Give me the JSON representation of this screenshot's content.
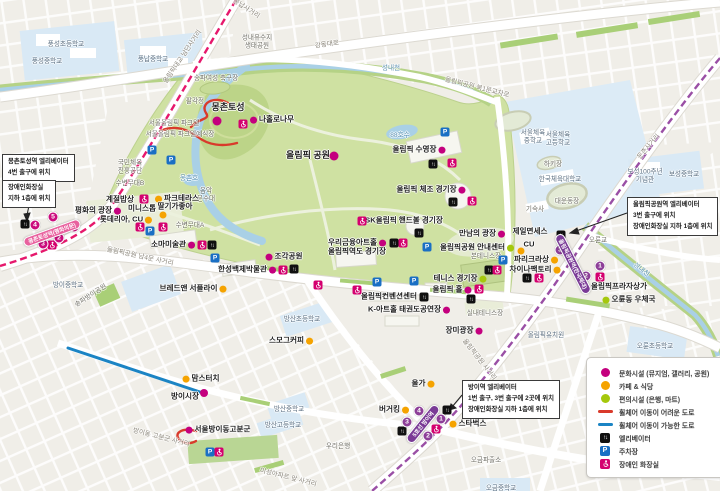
{
  "map": {
    "legend": {
      "items": [
        {
          "icon": "dot",
          "color": "#c4007e",
          "label": "문화시설 (뮤지엄, 갤러리, 공원)"
        },
        {
          "icon": "dot",
          "color": "#f5a300",
          "label": "카페 & 식당"
        },
        {
          "icon": "dot",
          "color": "#a5c80c",
          "label": "편의시설 (은행, 마트)"
        },
        {
          "icon": "line",
          "color": "#d93a2b",
          "label": "휠체어 이동이 어려운 도로"
        },
        {
          "icon": "line",
          "color": "#1b84c4",
          "label": "휠체어 이동이 가능한 도로"
        },
        {
          "icon": "elevator",
          "color": "#101010",
          "label": "엘리베이터"
        },
        {
          "icon": "parking",
          "color": "#1a6fc4",
          "label": "주차장"
        },
        {
          "icon": "toilet",
          "color": "#d4006f",
          "label": "장애인 화장실"
        }
      ]
    },
    "infoboxes": [
      {
        "id": "box-mongchon-elevator",
        "x": 2,
        "y": 154,
        "lines": [
          "몽촌토성역 엘리베이터",
          "4번 출구에 위치"
        ]
      },
      {
        "id": "box-mongchon-toilet",
        "x": 2,
        "y": 180,
        "lines": [
          "장애인화장실",
          "지하 1층에 위치"
        ]
      },
      {
        "id": "box-olympicpark-station",
        "x": 627,
        "y": 197,
        "lines": [
          "올림픽공원역 엘리베이터",
          "3번 출구에 위치",
          "장애인화장실 지하 1층에 위치"
        ]
      },
      {
        "id": "box-bangi-station",
        "x": 462,
        "y": 380,
        "lines": [
          "방이역 엘리베이터",
          "1번 출구, 3번 출구에 2곳에 위치",
          "장애인화장실 지하 1층에 위치"
        ]
      }
    ],
    "stations": [
      {
        "name": "몽촌토성역(평화의문)",
        "x": 52,
        "y": 233,
        "w": 60,
        "rot": -20,
        "color": "#e8619e"
      },
      {
        "name": "올림픽공원역(한국체대)",
        "x": 573,
        "y": 264,
        "w": 66,
        "rot": 63,
        "color": "#7a3b96"
      },
      {
        "name": "5호선 방이역",
        "x": 423,
        "y": 424,
        "w": 46,
        "rot": -51,
        "color": "#7a3b96"
      }
    ],
    "exits": [
      {
        "n": "1",
        "x": 74,
        "y": 227,
        "color": "#cb0c7d"
      },
      {
        "n": "2",
        "x": 59,
        "y": 238,
        "color": "#cb0c7d"
      },
      {
        "n": "3",
        "x": 43,
        "y": 244,
        "color": "#cb0c7d"
      },
      {
        "n": "4",
        "x": 35,
        "y": 225,
        "color": "#cb0c7d"
      },
      {
        "n": "5",
        "x": 53,
        "y": 217,
        "color": "#cb0c7d"
      },
      {
        "n": "3",
        "x": 560,
        "y": 250,
        "color": "#8d3f98"
      },
      {
        "n": "1",
        "x": 600,
        "y": 266,
        "color": "#8d3f98"
      },
      {
        "n": "2",
        "x": 586,
        "y": 276,
        "color": "#8d3f98"
      },
      {
        "n": "4",
        "x": 419,
        "y": 411,
        "color": "#8d3f98"
      },
      {
        "n": "3",
        "x": 407,
        "y": 422,
        "color": "#8d3f98"
      },
      {
        "n": "1",
        "x": 441,
        "y": 419,
        "color": "#8d3f98"
      },
      {
        "n": "2",
        "x": 428,
        "y": 436,
        "color": "#8d3f98"
      }
    ],
    "pois": [
      {
        "label": "풍성초등학교",
        "x": 66,
        "y": 45,
        "cls": "school"
      },
      {
        "label": "풍성중학교",
        "x": 47,
        "y": 62,
        "cls": "school"
      },
      {
        "label": "풍납중학교",
        "x": 153,
        "y": 60,
        "cls": "school"
      },
      {
        "lines": [
          "성내유수지",
          "생태공원"
        ],
        "x": 257,
        "y": 42,
        "cls": "area"
      },
      {
        "label": "송파여성 축구장",
        "x": 216,
        "y": 79,
        "cls": "area"
      },
      {
        "label": "팔각정",
        "x": 195,
        "y": 102,
        "cls": "area"
      },
      {
        "label": "서울올림픽 파크텔",
        "x": 174,
        "y": 124,
        "cls": "area"
      },
      {
        "label": "서울올림픽 파크텔예식장",
        "x": 180,
        "y": 135,
        "cls": "area"
      },
      {
        "label": "몽촌토성",
        "x": 228,
        "y": 107,
        "cls": "big"
      },
      {
        "label": "나홀로나무",
        "x": 272,
        "y": 120,
        "cls": "bold",
        "dot": {
          "color": "#c4007e",
          "side": "left"
        }
      },
      {
        "label": "올림픽 공원",
        "x": 308,
        "y": 155,
        "cls": "big"
      },
      {
        "label": "88호수",
        "x": 400,
        "y": 136,
        "cls": "water"
      },
      {
        "label": "몽촌호",
        "x": 189,
        "y": 179,
        "cls": "water"
      },
      {
        "lines": [
          "음악",
          "분수대"
        ],
        "x": 206,
        "y": 195,
        "cls": "area"
      },
      {
        "label": "수변무대B",
        "x": 130,
        "y": 184,
        "cls": "area"
      },
      {
        "label": "수변무대A",
        "x": 190,
        "y": 226,
        "cls": "area"
      },
      {
        "lines": [
          "국민체육",
          "진흥공단"
        ],
        "x": 130,
        "y": 167,
        "cls": "area"
      },
      {
        "label": "계절밥상",
        "x": 120,
        "y": 200,
        "cls": "bold"
      },
      {
        "label": "파크테라스",
        "x": 177,
        "y": 199,
        "cls": "bold",
        "dot": {
          "color": "#f5a300",
          "side": "left"
        }
      },
      {
        "label": "평화의 광장",
        "x": 98,
        "y": 211,
        "cls": "bold",
        "dot": {
          "color": "#c4007e",
          "side": "right"
        }
      },
      {
        "label": "미니스톱",
        "x": 142,
        "y": 209,
        "cls": "bold"
      },
      {
        "label": "딸기가좋아",
        "x": 175,
        "y": 207,
        "cls": "bold"
      },
      {
        "label": "롯데리아, CU",
        "x": 126,
        "y": 220,
        "cls": "bold",
        "dot": {
          "color": "#f5a300",
          "side": "right"
        }
      },
      {
        "label": "소마미술관",
        "x": 173,
        "y": 245,
        "cls": "bold",
        "dot": {
          "color": "#c4007e",
          "side": "right"
        }
      },
      {
        "label": "조각공원",
        "x": 284,
        "y": 257,
        "cls": "bold",
        "dot": {
          "color": "#c4007e",
          "side": "left"
        }
      },
      {
        "label": "한성백제박물관",
        "x": 247,
        "y": 270,
        "cls": "bold",
        "dot": {
          "color": "#c4007e",
          "side": "right"
        }
      },
      {
        "label": "브레드앤 서플라이",
        "x": 193,
        "y": 289,
        "cls": "bold",
        "dot": {
          "color": "#f5a300",
          "side": "right"
        }
      },
      {
        "label": "우리금융아트홀",
        "x": 357,
        "y": 243,
        "cls": "bold",
        "dot": {
          "color": "#c4007e",
          "side": "right"
        }
      },
      {
        "label": "올림픽역도 경기장",
        "x": 357,
        "y": 252,
        "cls": "bold"
      },
      {
        "label": "SK올림픽 핸드볼 경기장",
        "x": 404,
        "y": 221,
        "cls": "bold"
      },
      {
        "label": "올림픽 수영장",
        "x": 419,
        "y": 150,
        "cls": "bold",
        "dot": {
          "color": "#c4007e",
          "side": "right"
        }
      },
      {
        "label": "올림픽 체조 경기장",
        "x": 431,
        "y": 190,
        "cls": "bold",
        "dot": {
          "color": "#c4007e",
          "side": "right"
        }
      },
      {
        "label": "만남의 광장",
        "x": 482,
        "y": 234,
        "cls": "bold",
        "dot": {
          "color": "#c4007e",
          "side": "right"
        }
      },
      {
        "label": "올림픽공원 안내센터",
        "x": 477,
        "y": 248,
        "cls": "bold",
        "dot": {
          "color": "#a5c80c",
          "side": "right"
        }
      },
      {
        "label": "본테니스장",
        "x": 486,
        "y": 257,
        "cls": "area"
      },
      {
        "label": "테니스 경기장",
        "x": 460,
        "y": 279,
        "cls": "bold",
        "dot": {
          "color": "#a5c80c",
          "side": "right"
        }
      },
      {
        "label": "올림픽 홀",
        "x": 452,
        "y": 290,
        "cls": "bold",
        "dot": {
          "color": "#c4007e",
          "side": "right"
        }
      },
      {
        "label": "올림픽컨벤션센터",
        "x": 389,
        "y": 297,
        "cls": "bold"
      },
      {
        "label": "K-아트홀 태권도공연장",
        "x": 409,
        "y": 310,
        "cls": "bold",
        "dot": {
          "color": "#c4007e",
          "side": "right"
        }
      },
      {
        "label": "장미광장",
        "x": 464,
        "y": 331,
        "cls": "bold",
        "dot": {
          "color": "#c4007e",
          "side": "right"
        }
      },
      {
        "label": "실내테니스장",
        "x": 485,
        "y": 314,
        "cls": "area"
      },
      {
        "label": "제일면세스",
        "x": 530,
        "y": 232,
        "cls": "bold"
      },
      {
        "label": "CU",
        "x": 529,
        "y": 245,
        "cls": "bold"
      },
      {
        "label": "파리크라상",
        "x": 536,
        "y": 260,
        "cls": "bold",
        "dot": {
          "color": "#f5a300",
          "side": "right"
        }
      },
      {
        "label": "차이나팩토리",
        "x": 535,
        "y": 270,
        "cls": "bold",
        "dot": {
          "color": "#f5a300",
          "side": "right"
        }
      },
      {
        "lines": [
          "서울체육",
          "중학교"
        ],
        "x": 533,
        "y": 137,
        "cls": "school"
      },
      {
        "lines": [
          "서울체육",
          "고등학교"
        ],
        "x": 558,
        "y": 139,
        "cls": "school"
      },
      {
        "label": "하키장",
        "x": 553,
        "y": 165,
        "cls": "area"
      },
      {
        "label": "한국체육대학교",
        "x": 560,
        "y": 180,
        "cls": "school"
      },
      {
        "label": "대운동장",
        "x": 567,
        "y": 202,
        "cls": "area"
      },
      {
        "label": "기숙사",
        "x": 535,
        "y": 210,
        "cls": "area"
      },
      {
        "lines": [
          "보성100주년",
          "기념관"
        ],
        "x": 645,
        "y": 176,
        "cls": "school"
      },
      {
        "label": "보성중학교",
        "x": 684,
        "y": 175,
        "cls": "school"
      },
      {
        "label": "올림픽프라자상가",
        "x": 619,
        "y": 287,
        "cls": "bold"
      },
      {
        "label": "오륜동 우체국",
        "x": 629,
        "y": 300,
        "cls": "bold",
        "dot": {
          "color": "#a5c80c",
          "side": "left"
        }
      },
      {
        "label": "오륜교",
        "x": 598,
        "y": 241,
        "cls": "area"
      },
      {
        "label": "성내천",
        "x": 391,
        "y": 69,
        "cls": "water"
      },
      {
        "label": "성내천",
        "x": 641,
        "y": 270,
        "cls": "water",
        "rot": 38
      },
      {
        "label": "오륜초등학교",
        "x": 655,
        "y": 347,
        "cls": "school"
      },
      {
        "label": "올림픽유치원",
        "x": 546,
        "y": 336,
        "cls": "school"
      },
      {
        "label": "오금파출소",
        "x": 486,
        "y": 461,
        "cls": "area"
      },
      {
        "label": "오금중학교",
        "x": 501,
        "y": 489,
        "cls": "school"
      },
      {
        "label": "우리은행",
        "x": 338,
        "y": 447,
        "cls": "area"
      },
      {
        "label": "올가",
        "x": 423,
        "y": 384,
        "cls": "bold",
        "dot": {
          "color": "#f5a300",
          "side": "right"
        }
      },
      {
        "label": "버거킹",
        "x": 394,
        "y": 410,
        "cls": "bold",
        "dot": {
          "color": "#f5a300",
          "side": "right"
        }
      },
      {
        "label": "스타벅스",
        "x": 468,
        "y": 424,
        "cls": "bold",
        "dot": {
          "color": "#f5a300",
          "side": "left"
        }
      },
      {
        "label": "스모그커피",
        "x": 291,
        "y": 341,
        "cls": "bold",
        "dot": {
          "color": "#f5a300",
          "side": "right"
        }
      },
      {
        "label": "맘스터치",
        "x": 201,
        "y": 379,
        "cls": "bold",
        "dot": {
          "color": "#f5a300",
          "side": "left"
        }
      },
      {
        "label": "방이시장",
        "x": 185,
        "y": 397,
        "cls": "bold"
      },
      {
        "label": "서울방이동고분군",
        "x": 218,
        "y": 430,
        "cls": "bold",
        "dot": {
          "color": "#c4007e",
          "side": "left"
        }
      },
      {
        "label": "방산초등학교",
        "x": 302,
        "y": 320,
        "cls": "school"
      },
      {
        "label": "방산중학교",
        "x": 289,
        "y": 410,
        "cls": "school"
      },
      {
        "label": "방산고등학교",
        "x": 283,
        "y": 426,
        "cls": "school"
      },
      {
        "label": "방이중학교",
        "x": 68,
        "y": 286,
        "cls": "school"
      },
      {
        "label": "송파방이공원",
        "x": 91,
        "y": 296,
        "cls": "area",
        "rot": -33
      },
      {
        "label": "올림픽대교 남단사거리",
        "x": 183,
        "y": 57,
        "cls": "road",
        "rot": -56
      },
      {
        "label": "풍납사거리",
        "x": 246,
        "y": 9,
        "cls": "road",
        "rot": 33
      },
      {
        "label": "강동대로",
        "x": 327,
        "y": 45,
        "cls": "road",
        "rot": -8
      },
      {
        "label": "둔촌사거리",
        "x": 649,
        "y": 147,
        "cls": "road",
        "rot": -49
      },
      {
        "label": "올림픽공원 북1문교차로",
        "x": 477,
        "y": 88,
        "cls": "road",
        "rot": 14
      },
      {
        "label": "올림픽공원 남4문 사거리",
        "x": 140,
        "y": 257,
        "cls": "road",
        "rot": 12
      },
      {
        "label": "올림픽공원 사거리",
        "x": 479,
        "y": 360,
        "cls": "road",
        "rot": 52
      },
      {
        "label": "방이동 고분군 사거리",
        "x": 161,
        "y": 438,
        "cls": "road",
        "rot": 14
      },
      {
        "label": "미성아파트 앞 사거리",
        "x": 288,
        "y": 478,
        "cls": "road",
        "rot": 14
      }
    ],
    "standalone_dots": [
      {
        "color": "#c4007e",
        "x": 217,
        "y": 121,
        "r": 9
      },
      {
        "color": "#c4007e",
        "x": 334,
        "y": 156,
        "r": 9
      },
      {
        "color": "#c4007e",
        "x": 204,
        "y": 393,
        "r": 8
      },
      {
        "color": "#f5a300",
        "x": 163,
        "y": 215,
        "r": 7
      },
      {
        "color": "#f5a300",
        "x": 521,
        "y": 251,
        "r": 7
      }
    ],
    "facility_icons": [
      {
        "type": "parking",
        "x": 152,
        "y": 150
      },
      {
        "type": "parking",
        "x": 171,
        "y": 160
      },
      {
        "type": "parking",
        "x": 150,
        "y": 231
      },
      {
        "type": "parking",
        "x": 215,
        "y": 258
      },
      {
        "type": "parking",
        "x": 445,
        "y": 132
      },
      {
        "type": "parking",
        "x": 427,
        "y": 247
      },
      {
        "type": "parking",
        "x": 377,
        "y": 282
      },
      {
        "type": "parking",
        "x": 414,
        "y": 281
      },
      {
        "type": "parking",
        "x": 503,
        "y": 260
      },
      {
        "type": "parking",
        "x": 210,
        "y": 452
      },
      {
        "type": "elevator",
        "x": 25,
        "y": 224
      },
      {
        "type": "elevator",
        "x": 433,
        "y": 164
      },
      {
        "type": "elevator",
        "x": 453,
        "y": 202
      },
      {
        "type": "elevator",
        "x": 419,
        "y": 233
      },
      {
        "type": "elevator",
        "x": 394,
        "y": 243
      },
      {
        "type": "elevator",
        "x": 212,
        "y": 245
      },
      {
        "type": "elevator",
        "x": 294,
        "y": 269
      },
      {
        "type": "elevator",
        "x": 489,
        "y": 270
      },
      {
        "type": "elevator",
        "x": 471,
        "y": 299
      },
      {
        "type": "elevator",
        "x": 424,
        "y": 297
      },
      {
        "type": "elevator",
        "x": 561,
        "y": 235
      },
      {
        "type": "elevator",
        "x": 527,
        "y": 278
      },
      {
        "type": "elevator",
        "x": 447,
        "y": 410
      },
      {
        "type": "elevator",
        "x": 402,
        "y": 431
      },
      {
        "type": "toilet",
        "x": 52,
        "y": 245
      },
      {
        "type": "toilet",
        "x": 144,
        "y": 199
      },
      {
        "type": "toilet",
        "x": 140,
        "y": 227
      },
      {
        "type": "toilet",
        "x": 163,
        "y": 227
      },
      {
        "type": "toilet",
        "x": 202,
        "y": 245
      },
      {
        "type": "toilet",
        "x": 243,
        "y": 124
      },
      {
        "type": "toilet",
        "x": 283,
        "y": 270
      },
      {
        "type": "toilet",
        "x": 318,
        "y": 285
      },
      {
        "type": "toilet",
        "x": 452,
        "y": 163
      },
      {
        "type": "toilet",
        "x": 472,
        "y": 201
      },
      {
        "type": "toilet",
        "x": 362,
        "y": 221
      },
      {
        "type": "toilet",
        "x": 403,
        "y": 243
      },
      {
        "type": "toilet",
        "x": 357,
        "y": 290
      },
      {
        "type": "toilet",
        "x": 497,
        "y": 270
      },
      {
        "type": "toilet",
        "x": 479,
        "y": 289
      },
      {
        "type": "toilet",
        "x": 539,
        "y": 278
      },
      {
        "type": "toilet",
        "x": 600,
        "y": 277
      },
      {
        "type": "toilet",
        "x": 436,
        "y": 429
      },
      {
        "type": "toilet",
        "x": 219,
        "y": 452
      }
    ]
  }
}
